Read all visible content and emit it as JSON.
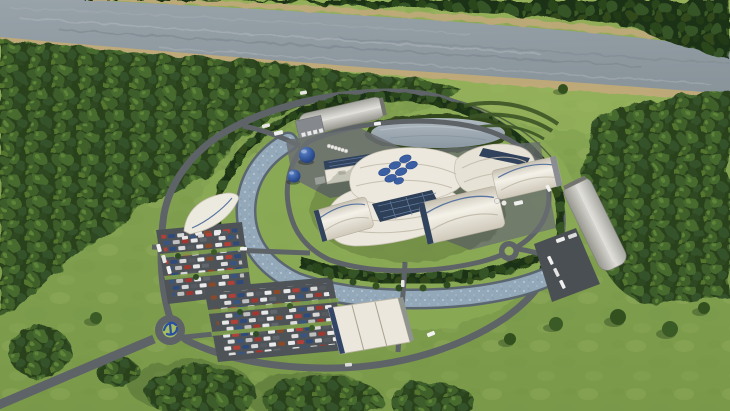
{
  "description": "Aerial 3D architectural rendering of a small modular reactor power plant campus: circular ring road around white wavy-roofed reactor complex with blue module logo, cooling canal arc, parking lots full of cars, roundabout entrance, gray arched warehouses, oval pond, surrounded by forest and a river along the top",
  "palette": {
    "riverWater": "#8f99a0",
    "riverLight": "#b3bcc1",
    "riverDark": "#77828a",
    "sand": "#c3a97d",
    "farForest": "#24381a",
    "forest": "#31491f",
    "forestLight": "#55742f",
    "grass": "#7e9e4d",
    "grassLight": "#96b35c",
    "grassBright": "#a4bd62",
    "grassDark": "#5f7f3a",
    "road": "#5e6367",
    "roadDark": "#43484d",
    "parking": "#4e5357",
    "hedge": "#24381b",
    "canal": "#93a9ba",
    "canalBank": "#5b6670",
    "pond": "#9fadb7",
    "roofWhite": "#ebe7dc",
    "roofShade": "#c9c3b4",
    "glassBlue": "#31435c",
    "logoBlue": "#3a5fa3",
    "tankBlue": "#2d4f94",
    "warehouseGray": "#b5b5af",
    "white": "#f2f2f0"
  },
  "scene": {
    "river": {
      "position": "top",
      "banks": "sandy"
    },
    "far_shore_forest": {
      "position": "top edge"
    },
    "left_forest": {
      "position": "upper left"
    },
    "right_forest": {
      "position": "right"
    },
    "campus": {
      "shape": "circular ring road",
      "entrance_roundabouts": 1,
      "inner_mini_roundabouts": 1,
      "cooling_canal": "blue arc sweeping west and south",
      "hedge_ring": true,
      "pond": "oval, north of complex",
      "reactor_complex": {
        "roof": "white wavy shells",
        "logo_modules": 7,
        "glass_atrium": "dark blue diagonal"
      },
      "arched_buildings": 3,
      "flat_roof_building": 1,
      "south_slant_building": 1,
      "sail_canopy": 1,
      "warehouses": {
        "northwest": 1,
        "east": 1
      },
      "spherical_tanks": 2,
      "white_tank_row": 6,
      "parking_lots": 2,
      "entrance_road": "from bottom-left corner",
      "roundabout_sculpture": "blue abstract"
    }
  }
}
